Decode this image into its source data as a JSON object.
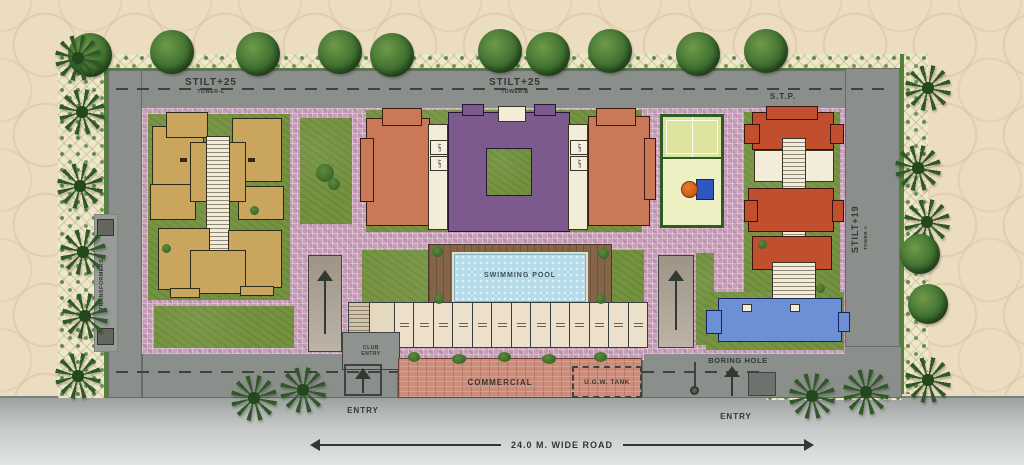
{
  "plan": {
    "towers": [
      {
        "stilt": "STILT+25",
        "name": "TOWER-C"
      },
      {
        "stilt": "STILT+25",
        "name": "TOWER-B"
      },
      {
        "stilt": "STILT+19",
        "name": "TOWER A"
      }
    ],
    "labels": {
      "stp": "S.T.P.",
      "transformers": "TRANSFORMERS",
      "swimming_pool": "SWIMMING POOL",
      "lift": "LIFT",
      "club_entry": "CLUB ENTRY",
      "commercial": "COMMERCIAL",
      "ugw_tank": "U.G.W. TANK",
      "boring_hole": "BORING HOLE",
      "entry_left": "ENTRY",
      "entry_right": "ENTRY",
      "road": "24.0 M. WIDE ROAD"
    },
    "colors": {
      "background": "#ecdcc0",
      "road": "#8b8f8b",
      "lawn": "#74923f",
      "paving": "#c79fb9",
      "tower_c": "#c9a55d",
      "tower_b_core": "#7d5a8d",
      "tower_b_wing": "#c97957",
      "tower_a": "#c14f2e",
      "tower_a_annex": "#6d8fd6",
      "pool": "#b5dce9",
      "deck": "#84654a",
      "commercial_block": "#cb8d7a",
      "hedge": "#efe7c9",
      "court": "#e4e8ac"
    }
  }
}
